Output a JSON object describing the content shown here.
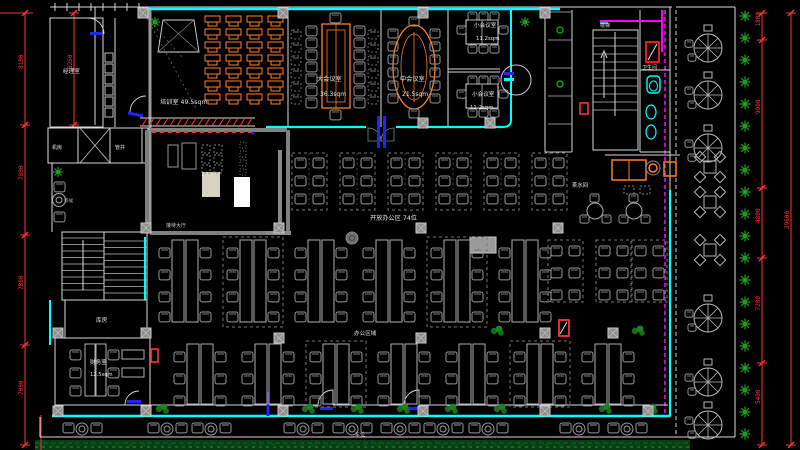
{
  "colors": {
    "background": "#000000",
    "wall": "#d9d9d9",
    "glass_wall": "#00ffff",
    "furniture_accent": "#ff7f27",
    "furniture_gray": "#9a9a9a",
    "dimension": "#ff3232",
    "vegetation": "#1f9e1f",
    "hedge": "#0a3d14",
    "pipe": "#ff00ff",
    "door_accent": "#2222ff"
  },
  "rooms": {
    "training": {
      "label": "培训室 49.5sqm"
    },
    "meeting_large": {
      "name": "大会议室",
      "area": "36.3sqm"
    },
    "meeting_medium": {
      "name": "中会议室",
      "area": "21.5sqm"
    },
    "meeting_small_a": {
      "name": "小会议室",
      "area": "11.2sqm"
    },
    "meeting_small_b": {
      "name": "小会议室",
      "area": "11.2sqm"
    },
    "open_office": {
      "label": "开放办公区 74位"
    },
    "office_area": {
      "label": "办公区域"
    },
    "pantry": {
      "label": "茶水间"
    },
    "reception": {
      "label": "接待大厅"
    },
    "manager": {
      "label": "经理室"
    },
    "machine_room": {
      "label": "机房"
    },
    "shaft": {
      "label": "管井"
    },
    "storage": {
      "label": "库房"
    },
    "finance": {
      "name": "财务室",
      "area": "12.5sqm"
    },
    "waiting": {
      "label": "等候"
    },
    "restroom": {
      "label": "卫生间"
    },
    "stairs_top": {
      "label": "楼梯"
    },
    "parking": {
      "label": "车位"
    }
  },
  "dimensions": {
    "left_inner": {
      "x": 25,
      "ticks": [
        13,
        125,
        235,
        345,
        445
      ],
      "values": [
        "8100",
        "7800",
        "7800",
        "7000"
      ]
    },
    "left_short": {
      "x": 74,
      "ticks": [
        13,
        125
      ],
      "values": [
        "8250"
      ]
    },
    "right_inner": {
      "x": 762,
      "ticks": [
        13,
        40,
        188,
        258,
        363,
        445
      ],
      "values": [
        "1800",
        "9900",
        "4800",
        "7200",
        "5400"
      ]
    },
    "right_outer": {
      "x": 791,
      "ticks": [
        13,
        445
      ],
      "values": [
        "39600"
      ]
    }
  }
}
